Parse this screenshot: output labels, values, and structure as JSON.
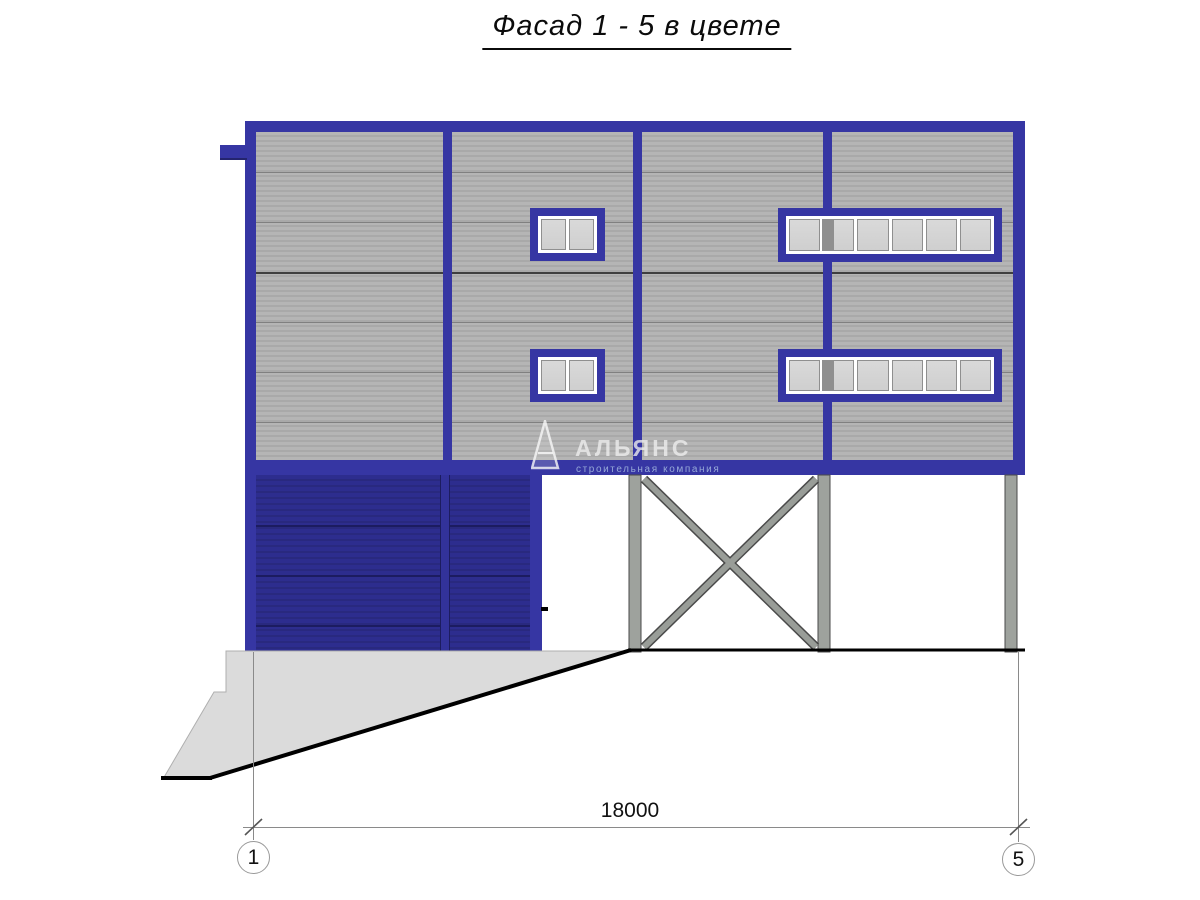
{
  "title": "Фасад 1 - 5 в цвете",
  "watermark": {
    "logo": "alliance-triangle-logo",
    "name": "АЛЬЯНС",
    "tagline": "строительная компания"
  },
  "dimension": {
    "span_label": "18000",
    "axis_start": "1",
    "axis_end": "5"
  },
  "colors": {
    "trim_blue": "#3636A3",
    "wall_navy": "#2B2B88",
    "siding_light": "#B5B5B5",
    "siding_dark": "#A9A9A9",
    "column_gray": "#9EA29D",
    "concrete_gray": "#DBDBDB",
    "glass_gray": "#D4D4D4"
  },
  "windows": [
    {
      "id": "window-upper-left",
      "x": 530,
      "y": 208,
      "w": 75,
      "h": 53,
      "panes": 2,
      "dark_strip": null
    },
    {
      "id": "window-upper-right",
      "x": 778,
      "y": 208,
      "w": 224,
      "h": 54,
      "panes": 6,
      "dark_strip": {
        "left": 44,
        "width": 12
      }
    },
    {
      "id": "window-lower-left",
      "x": 530,
      "y": 349,
      "w": 75,
      "h": 53,
      "panes": 2,
      "dark_strip": null
    },
    {
      "id": "window-lower-right",
      "x": 778,
      "y": 349,
      "w": 224,
      "h": 53,
      "panes": 6,
      "dark_strip": {
        "left": 44,
        "width": 12
      }
    }
  ]
}
